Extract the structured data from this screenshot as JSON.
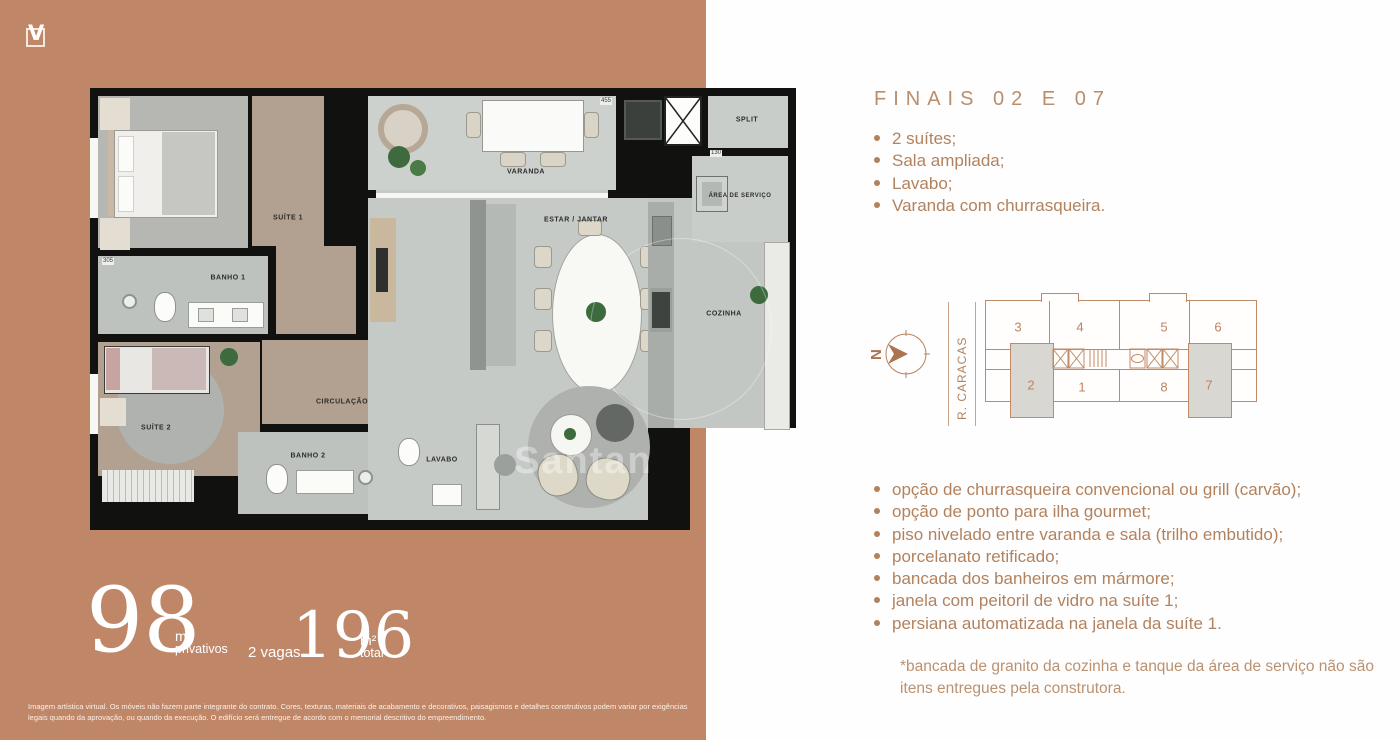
{
  "logo": {
    "letter": "V"
  },
  "floorplan": {
    "rooms": {
      "suite1": "SUÍTE 1",
      "banho1": "BANHO 1",
      "suite2": "SUÍTE 2",
      "banho2": "BANHO 2",
      "lavabo": "LAVABO",
      "circulacao": "CIRCULAÇÃO",
      "varanda": "VARANDA",
      "estar_jantar": "ESTAR / JANTAR",
      "cozinha": "COZINHA",
      "area_servico": "ÁREA DE SERVIÇO",
      "split": "SPLIT"
    },
    "dims": {
      "varanda": "455",
      "split": "130",
      "banho1": "305"
    },
    "watermark": "Santan"
  },
  "areas": {
    "private_value": "98",
    "private_unit": "m²",
    "private_label": "privativos",
    "parking": "2 vagas",
    "total_value": "196",
    "total_unit": "m²",
    "total_label": "total"
  },
  "details": {
    "heading": "FINAIS 02 E 07",
    "features": [
      "2 suítes;",
      "Sala ampliada;",
      "Lavabo;",
      "Varanda com churrasqueira."
    ],
    "options": [
      "opção de churrasqueira convencional ou grill (carvão);",
      "opção de ponto para ilha gourmet;",
      "piso nivelado entre varanda e sala (trilho embutido);",
      "porcelanato retificado;",
      "bancada dos banheiros em mármore;",
      "janela com peitoril de vidro na suíte 1;",
      "persiana automatizada na janela da suíte 1."
    ],
    "footnote": "*bancada de granito da cozinha e tanque da área de serviço não são itens entregues pela construtora."
  },
  "keyplan": {
    "north": "N",
    "street": "R. CARACAS",
    "units_top": [
      "3",
      "4",
      "5",
      "6"
    ],
    "units_bottom": [
      "2",
      "1",
      "8",
      "7"
    ],
    "highlighted_units": [
      "2",
      "7"
    ]
  },
  "disclaimer": "Imagem artística virtual. Os móveis não fazem parte integrante do contrato. Cores, texturas, materiais de acabamento e decorativos, paisagismos e detalhes construtivos podem variar por exigências legais quando da aprovação, ou quando da execução. O edifício será entregue de acordo com o memorial descritivo do empreendimento.",
  "colors": {
    "panel_background": "#bf8767",
    "accent_text": "#b2825e",
    "plan_walls": "#111110",
    "keyplan_line": "#c08a66",
    "keyplan_highlight": "#d8d7d2"
  }
}
